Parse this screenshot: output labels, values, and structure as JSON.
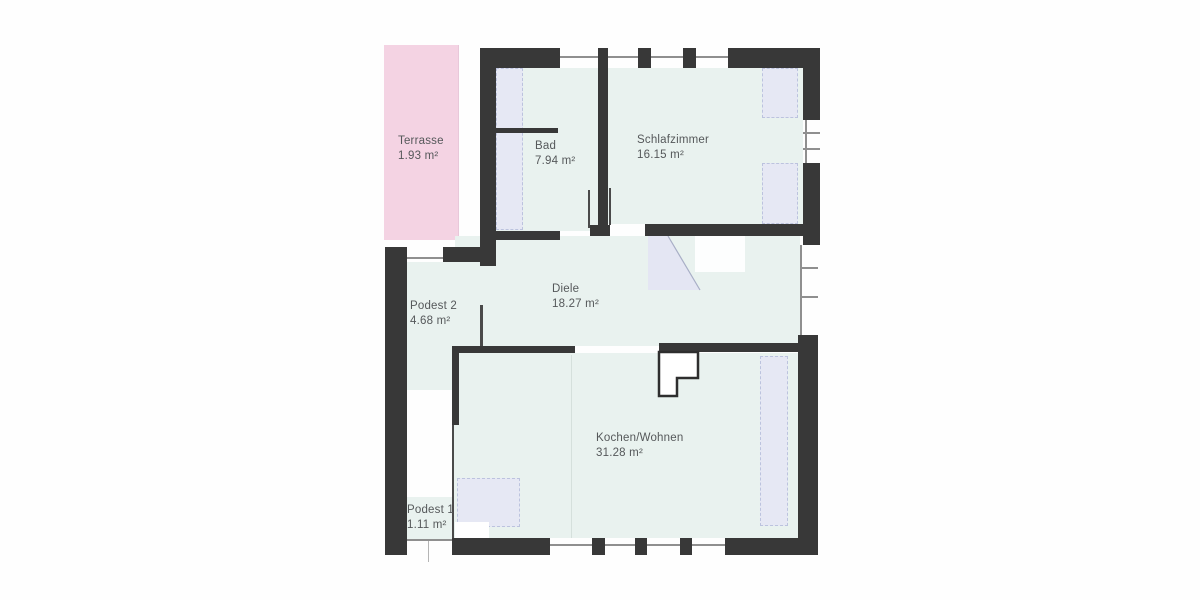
{
  "plan": {
    "type": "floor-plan",
    "rooms": {
      "terrasse": {
        "name": "Terrasse",
        "area": "1.93 m²"
      },
      "bad": {
        "name": "Bad",
        "area": "7.94 m²"
      },
      "schlafzimmer": {
        "name": "Schlafzimmer",
        "area": "16.15 m²"
      },
      "diele": {
        "name": "Diele",
        "area": "18.27 m²"
      },
      "podest2": {
        "name": "Podest 2",
        "area": "4.68 m²"
      },
      "kochen_wohnen": {
        "name": "Kochen/Wohnen",
        "area": "31.28 m²"
      },
      "podest1": {
        "name": "Podest 1",
        "area": "1.11 m²"
      }
    },
    "colors": {
      "wall": "#383838",
      "room": "#e9f2ef",
      "terrace": "#f4d3e3",
      "furniture": "#e6e8f4",
      "furnborder": "#bcc3de",
      "window": "#8f8f8f",
      "text": "#55585a",
      "faint": "#d5e0dc",
      "swing": "#e4e6f3"
    }
  }
}
